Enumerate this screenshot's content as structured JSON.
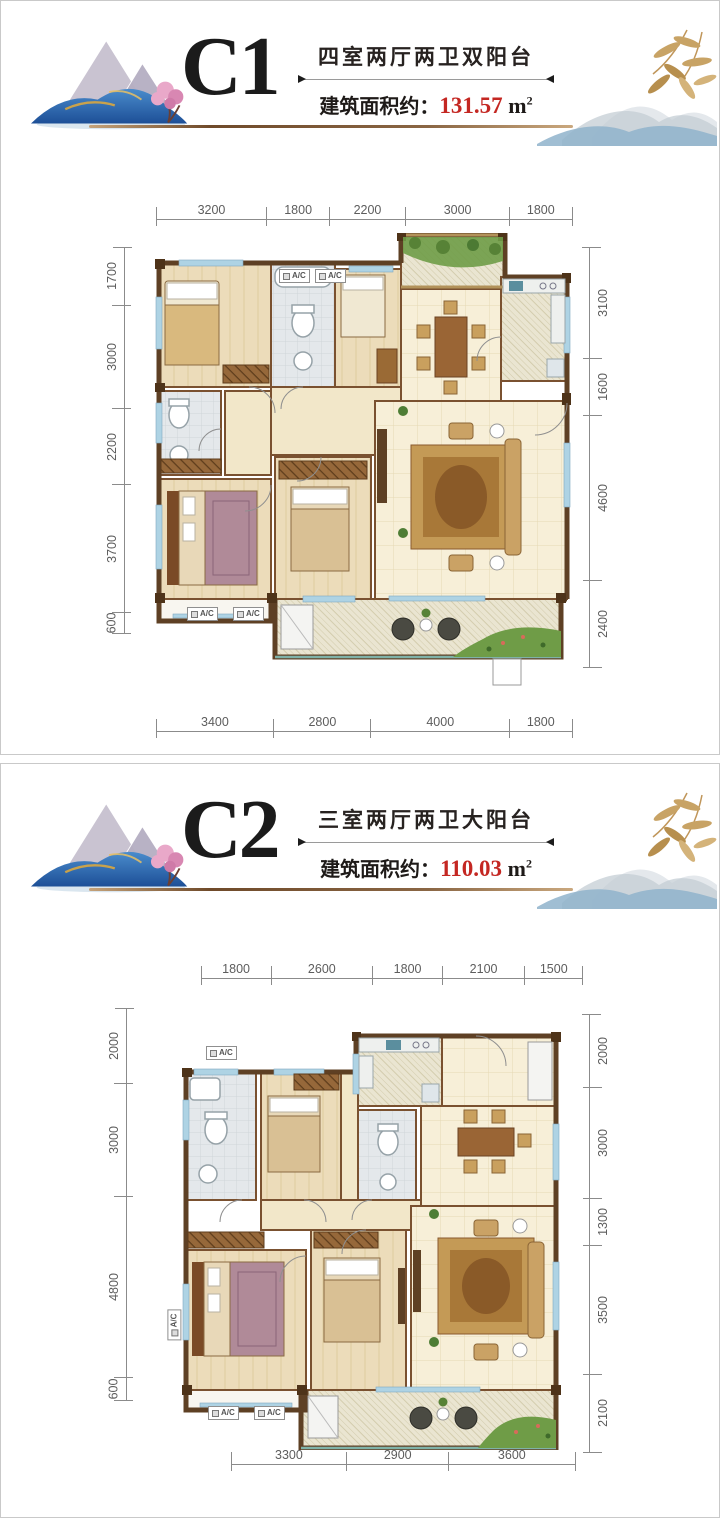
{
  "page": {
    "background": "#ffffff",
    "panel_border": "#c9c9c9"
  },
  "colors": {
    "accent_red": "#c42722",
    "rule_brown": "#8a6644",
    "dim_line": "#8b8b8b",
    "wall_brown": "#5e4024",
    "wall_tan": "#b2925a",
    "window_blue": "#aed3e4"
  },
  "panels": [
    {
      "unit_label": "C1",
      "descriptor": "四室两厅两卫双阳台",
      "area_prefix": "建筑面积约：",
      "area_value": "131.57",
      "area_unit": "m",
      "area_sup": "2",
      "dims": {
        "top": [
          "3200",
          "1800",
          "2200",
          "3000",
          "1800"
        ],
        "left": [
          "1700",
          "3000",
          "2200",
          "3700",
          "600"
        ],
        "right": [
          "3100",
          "1600",
          "4600",
          "2400"
        ],
        "bottom": [
          "3400",
          "2800",
          "4000",
          "1800"
        ]
      },
      "ac_labels": {
        "top": [
          "A/C",
          "A/C"
        ],
        "bottom": [
          "A/C",
          "A/C"
        ]
      }
    },
    {
      "unit_label": "C2",
      "descriptor": "三室两厅两卫大阳台",
      "area_prefix": "建筑面积约：",
      "area_value": "110.03",
      "area_unit": "m",
      "area_sup": "2",
      "dims": {
        "top": [
          "1800",
          "2600",
          "1800",
          "2100",
          "1500"
        ],
        "left": [
          "2000",
          "3000",
          "4800",
          "600"
        ],
        "right": [
          "2000",
          "3000",
          "1300",
          "3500",
          "2100"
        ],
        "bottom": [
          "3300",
          "2900",
          "3600"
        ]
      },
      "ac_labels": {
        "top": [
          "A/C"
        ],
        "bottom": [
          "A/C",
          "A/C"
        ],
        "left": [
          "A/C"
        ]
      }
    }
  ]
}
